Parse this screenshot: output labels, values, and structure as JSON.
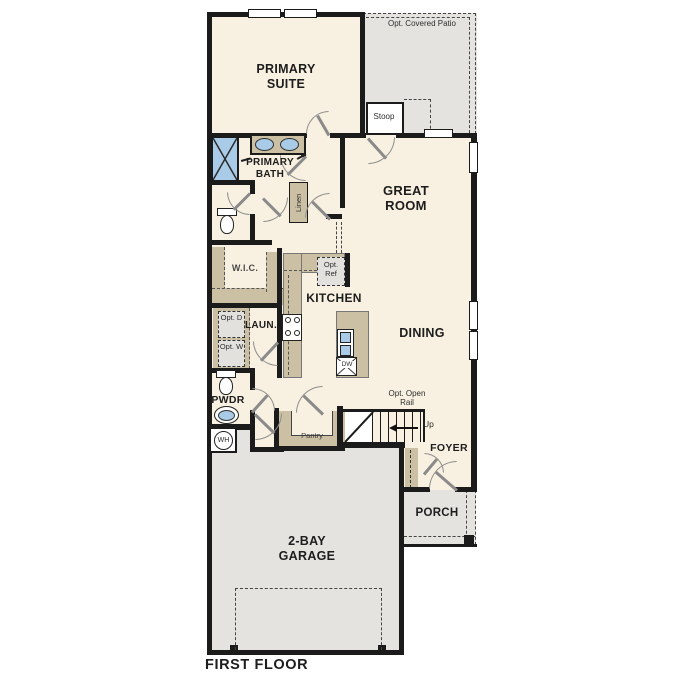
{
  "plan_title": "FIRST FLOOR",
  "rooms": {
    "primary_suite": "PRIMARY SUITE",
    "primary_bath": "PRIMARY BATH",
    "wic": "W.I.C.",
    "laundry": "LAUN.",
    "powder": "PWDR",
    "kitchen": "KITCHEN",
    "great_room": "GREAT ROOM",
    "dining": "DINING",
    "foyer": "FOYER",
    "porch": "PORCH",
    "garage": "2-BAY GARAGE",
    "pantry": "Pantry",
    "stoop": "Stoop",
    "covered_patio": "Opt. Covered Patio"
  },
  "fixtures": {
    "linen_closet": "Linen",
    "optional_refrigerator": "Opt. Ref",
    "optional_dryer": "Opt. D",
    "optional_washer": "Opt. W",
    "dishwasher": "DW",
    "water_heater": "WH"
  },
  "annotations": {
    "stairs_direction": "Up",
    "optional_open_rail": "Opt. Open Rail"
  },
  "colors": {
    "wall": "#1b1b1b",
    "room_fill": "#f8f0e0",
    "outdoor_fill": "#e4e3e0",
    "casework_fill": "#cbbfa4",
    "fixture_blue": "#a9cbe7",
    "door_gray": "#8a8a8a"
  }
}
